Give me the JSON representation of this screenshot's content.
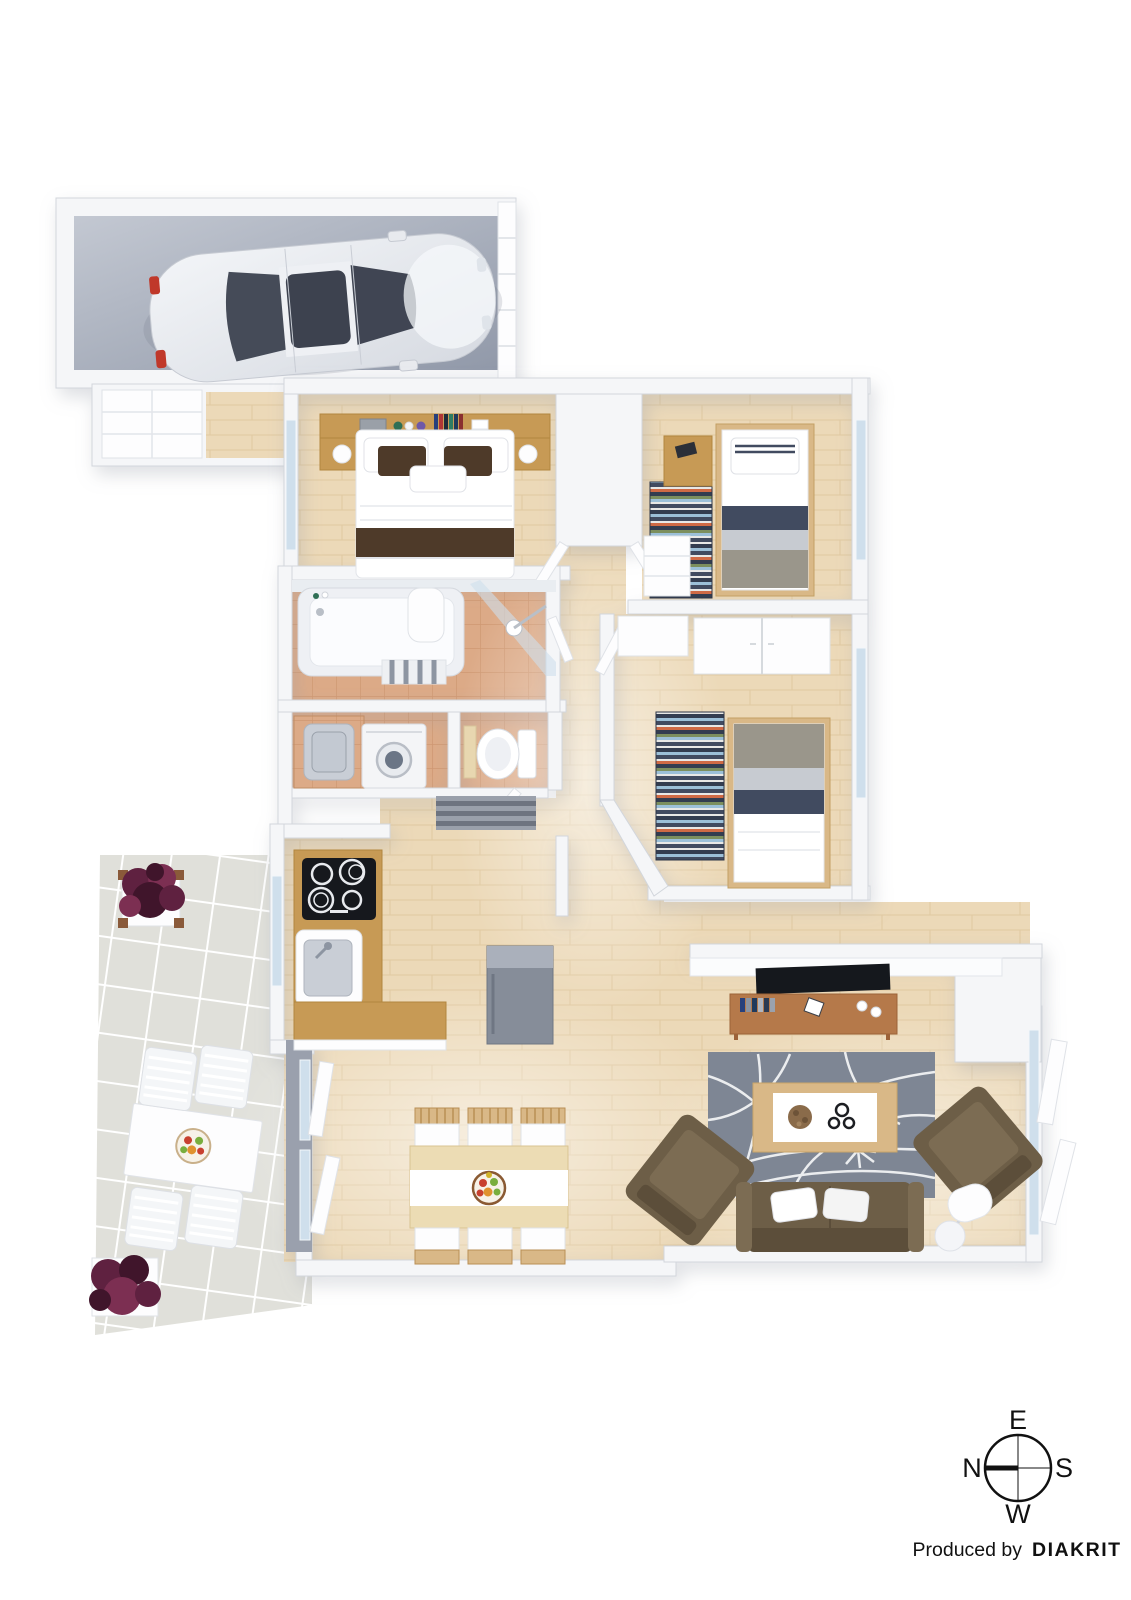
{
  "compass": {
    "labels": {
      "top": "E",
      "right": "S",
      "bottom": "W",
      "left": "N"
    },
    "needle_points_to": "N"
  },
  "credit": {
    "prefix": "Produced by",
    "brand": "DIAKRIT"
  },
  "rooms": [
    "garage",
    "entry",
    "master-bedroom",
    "bedroom-2",
    "bedroom-3",
    "bathroom",
    "laundry",
    "wc",
    "kitchen",
    "hallway",
    "dining-area",
    "living-room",
    "patio"
  ],
  "objects": [
    "car",
    "double-bed",
    "single-bed",
    "striped-runner-rug",
    "bathtub",
    "shower",
    "washing-machine",
    "toilet",
    "cooktop",
    "kitchen-sink",
    "fridge",
    "dining-table",
    "fruit-bowl",
    "tv",
    "tv-bench",
    "leaf-pattern-rug",
    "coffee-table",
    "armchair",
    "sofa",
    "floor-lamp",
    "patio-table",
    "patio-chair",
    "flower-planter",
    "compass-rose"
  ],
  "colors": {
    "background": "#ffffff",
    "wall": "#f5f6f8",
    "wall_edge": "#d2d6dc",
    "wood_floor": "#ecd9b8",
    "wood_line": "#e0c9a1",
    "oak": "#c79a55",
    "oak_edge": "#b2863f",
    "bench": "#b5794a",
    "garage_light": "#c3c8d2",
    "garage_dark": "#9199a9",
    "patio_tile": "#e0e0da",
    "terracotta": "#dcaa87",
    "terracotta_line": "#cf9872",
    "glass": "#cfdfec",
    "rug": "#7e8694",
    "sofa": "#6d5e47",
    "sofa_dark": "#5c4e3a",
    "cushion": "#7c6c53",
    "pillow_brown": "#4e3a29",
    "navy": "#414b60",
    "band_light": "#c7cbd1",
    "band_taupe": "#9a968b",
    "stripe_blue": "#9cc0d8",
    "stripe_orange": "#cf6a45",
    "stripe_olive": "#7c8f5e",
    "stripe_dark": "#333d50",
    "steel": "#c9ced6",
    "dark": "#15181d",
    "foliage": "#5f2140",
    "foliage_dark": "#40152b",
    "foliage_light": "#7c2f52",
    "text": "#111111"
  }
}
